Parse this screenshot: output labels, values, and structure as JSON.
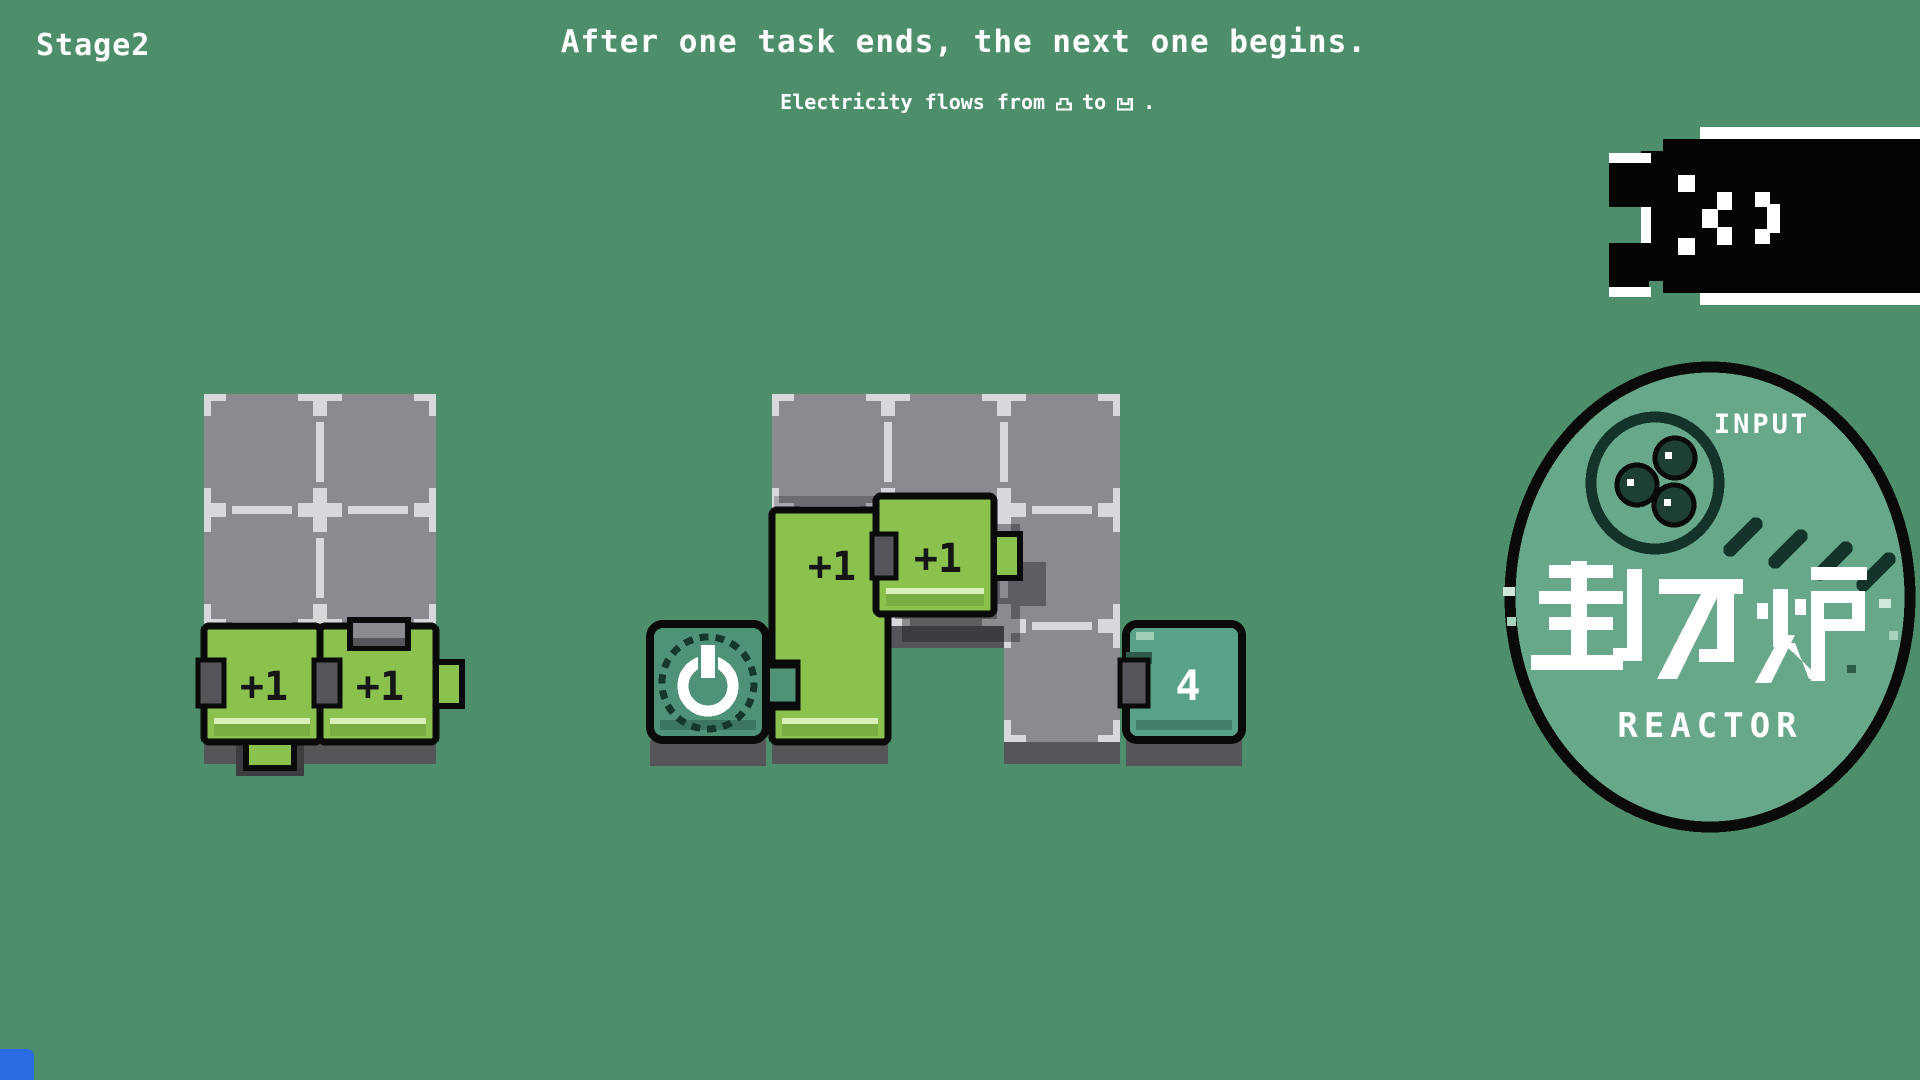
{
  "header": {
    "stage_label": "Stage2",
    "title": "After one task ends, the next one begins.",
    "subtitle": {
      "prefix": "Electricity flows from",
      "middle": "to",
      "suffix": ".",
      "from_icon": "tab-connector-icon",
      "to_icon": "notch-connector-icon"
    }
  },
  "boards": {
    "left": {
      "x": 204,
      "y": 394,
      "cell": 116,
      "cells": [
        [
          0,
          0
        ],
        [
          1,
          0
        ],
        [
          0,
          1
        ],
        [
          1,
          1
        ],
        [
          0,
          2
        ],
        [
          1,
          2
        ]
      ]
    },
    "middle": {
      "x": 772,
      "y": 394,
      "cell": 116,
      "cells": [
        [
          0,
          0
        ],
        [
          1,
          0
        ],
        [
          2,
          0
        ],
        [
          0,
          1
        ],
        [
          1,
          1
        ],
        [
          2,
          1
        ],
        [
          0,
          2
        ],
        [
          2,
          2
        ]
      ]
    }
  },
  "pieces": {
    "left_a": {
      "label": "+1"
    },
    "left_b": {
      "label": "+1"
    },
    "tall": {
      "label": "+1"
    },
    "floating": {
      "label": "+1"
    },
    "output": {
      "label": "4"
    },
    "power": {
      "icon": "power-icon"
    }
  },
  "badge": {
    "input_label": "INPUT",
    "kanji": "動力炉",
    "reactor_label": "REACTOR"
  },
  "mascot": {
    "face": ":<)"
  },
  "colors": {
    "bg": "#4e8f6b",
    "cell": "#8c8a90",
    "tick": "#d9d7db",
    "depth": "#57545a",
    "deep": "#3e3c41",
    "piece-green": "#8bc24d",
    "piece-light": "#d8efbb",
    "piece-band": "#79ad41",
    "teal": "#4e9378",
    "teal-dark": "#3c7560",
    "output": "#58a287",
    "output-dark": "#437e69",
    "badge": "#67a78a",
    "badge-dark": "#14332a",
    "corner-blue": "#2b6be4"
  }
}
